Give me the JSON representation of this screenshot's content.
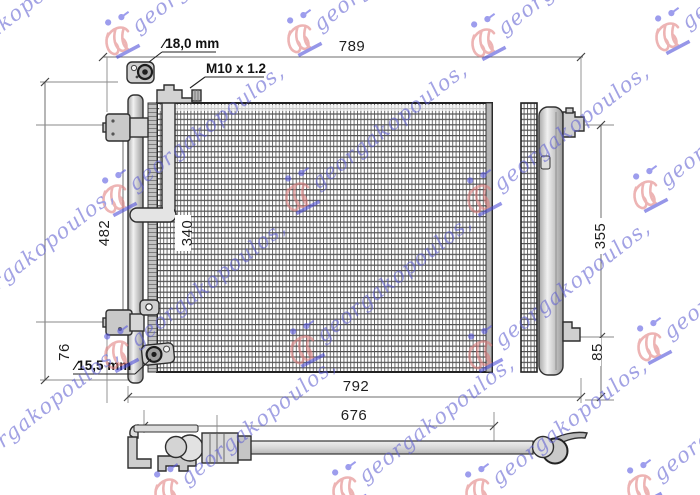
{
  "watermark": {
    "text": "georgakopoulos,",
    "text_color": "#5f5fd0",
    "crest_color": "#e07d7d",
    "accent_blue": "#4a4ad8"
  },
  "dimensions": {
    "top_width": "789",
    "overall_width": "792",
    "pipe_length": "676",
    "overall_height": "482",
    "bracket_span": "340",
    "bottom_offset": "76",
    "side_height": "355",
    "side_bottom_offset": "85"
  },
  "callouts": {
    "top_port_diameter": "∕18,0 mm",
    "thread_spec": "M10 x 1.2",
    "bottom_port_diameter": "∕15,5 mm"
  }
}
